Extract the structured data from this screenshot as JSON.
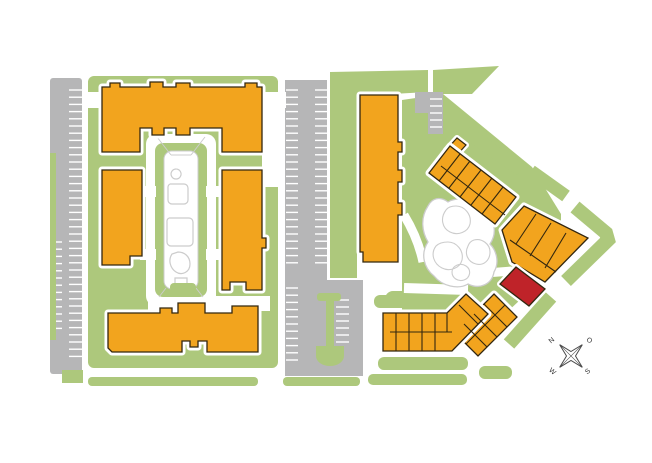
{
  "meta": {
    "viewbox": "0 0 652 463",
    "width": "652",
    "height": "463"
  },
  "colors": {
    "background": "#ffffff",
    "grass": "#adc87c",
    "building": "#f2a41e",
    "highlight": "#bf2329",
    "paving": "#b6b6b7",
    "stall": "#ffffff",
    "outline": "#33270f",
    "path_gray": "#cccccc",
    "halo": "#ffffff",
    "compass": "#4a4a4a",
    "label": "#333333"
  },
  "compass": {
    "labels": {
      "n": "N",
      "e": "O",
      "s": "S",
      "w": "W"
    }
  },
  "layers": [
    {
      "name": "grass-areas",
      "items": [
        {
          "t": "rect",
          "n": "grass-left-block",
          "x": 88,
          "y": 76,
          "w": 190,
          "h": 292,
          "rx": 6,
          "f": "grass"
        },
        {
          "t": "rect",
          "n": "grass-bottom-strip-a",
          "x": 88,
          "y": 377,
          "w": 170,
          "h": 9,
          "rx": 4,
          "f": "grass"
        },
        {
          "t": "rect",
          "n": "grass-bottom-strip-b",
          "x": 283,
          "y": 377,
          "w": 77,
          "h": 9,
          "rx": 4,
          "f": "grass"
        },
        {
          "t": "poly",
          "n": "grass-mid-column",
          "pts": "330,72 428,70 428,92 357,96 357,278 330,278",
          "f": "grass"
        },
        {
          "t": "poly",
          "n": "grass-top-wedge",
          "pts": "433,70 499,66 472,94 433,94",
          "f": "grass"
        },
        {
          "t": "poly",
          "n": "grass-inner-courtyard",
          "pts": "402,100 443,94 532,167 561,214 561,246 520,300 472,345 435,332 402,312",
          "f": "grass"
        },
        {
          "t": "rect",
          "n": "grass-island-a",
          "x": 385,
          "y": 291,
          "w": 46,
          "h": 16,
          "rx": 8,
          "f": "grass"
        },
        {
          "t": "rect",
          "n": "grass-island-b",
          "x": 427,
          "y": 266,
          "w": 33,
          "h": 15,
          "rx": 7,
          "f": "grass"
        },
        {
          "t": "rect",
          "n": "grass-chain-top-strip",
          "x": 374,
          "y": 295,
          "w": 88,
          "h": 13,
          "rx": 6,
          "f": "grass"
        },
        {
          "t": "rect",
          "n": "grass-chain-bottom-strip",
          "x": 378,
          "y": 357,
          "w": 90,
          "h": 13,
          "rx": 6,
          "f": "grass"
        },
        {
          "t": "rect",
          "n": "grass-chain-bottom-strip-2",
          "x": 368,
          "y": 374,
          "w": 99,
          "h": 11,
          "rx": 5,
          "f": "grass"
        },
        {
          "t": "rect",
          "n": "grass-se-connector",
          "x": 479,
          "y": 366,
          "w": 33,
          "h": 13,
          "rx": 6,
          "f": "grass"
        },
        {
          "t": "path",
          "n": "grass-ne-band-a",
          "d": "M466,132 L521,170",
          "f": "none",
          "s": "grass",
          "sw": 13
        },
        {
          "t": "path",
          "n": "grass-ne-band-b",
          "d": "M531,171 L566,196",
          "f": "none",
          "s": "grass",
          "sw": 13
        },
        {
          "t": "path",
          "n": "grass-ne-band-c",
          "d": "M575,207 L606,233 L608,240 L566,281",
          "f": "none",
          "s": "grass",
          "sw": 14
        },
        {
          "t": "path",
          "n": "grass-se-band-d",
          "d": "M551,297 L509,344",
          "f": "none",
          "s": "grass",
          "sw": 14
        }
      ]
    },
    {
      "name": "paving-areas",
      "items": [
        {
          "t": "rect",
          "n": "parking-lot-west",
          "x": 50,
          "y": 78,
          "w": 32,
          "h": 296,
          "rx": 3,
          "f": "paving"
        },
        {
          "t": "poly",
          "n": "parking-lot-central",
          "pts": "285,80 327,80 327,280 363,280 363,376 285,376",
          "f": "paving"
        },
        {
          "t": "poly",
          "n": "parking-patch-north",
          "pts": "415,92 443,92 443,134 428,134 428,113 415,113",
          "f": "paving"
        }
      ]
    },
    {
      "name": "parking-stalls",
      "items": [
        {
          "t": "ticks",
          "n": "stalls-west",
          "x1": 69,
          "x2": 82,
          "y": 90,
          "step": 7.2,
          "count": 38,
          "s": "stall",
          "sw": 1.4
        },
        {
          "t": "ticks",
          "n": "stalls-west-lower",
          "x1": 50,
          "x2": 62,
          "y": 242,
          "step": 7.2,
          "count": 13,
          "s": "stall",
          "sw": 1.4
        },
        {
          "t": "ticks",
          "n": "stalls-central-left",
          "x1": 286,
          "x2": 298,
          "y": 90,
          "step": 7.2,
          "count": 25,
          "s": "stall",
          "sw": 1.4
        },
        {
          "t": "ticks",
          "n": "stalls-central-right",
          "x1": 315,
          "x2": 327,
          "y": 90,
          "step": 7.2,
          "count": 25,
          "s": "stall",
          "sw": 1.4
        },
        {
          "t": "ticks",
          "n": "stalls-central-lower",
          "x1": 286,
          "x2": 298,
          "y": 288,
          "step": 7.2,
          "count": 11,
          "s": "stall",
          "sw": 1.4
        },
        {
          "t": "ticks",
          "n": "stalls-island-stem",
          "x1": 336,
          "x2": 349,
          "y": 300,
          "step": 7,
          "count": 7,
          "s": "stall",
          "sw": 1.4
        },
        {
          "t": "ticks",
          "n": "stalls-north-patch",
          "x1": 430,
          "x2": 442,
          "y": 99,
          "step": 7,
          "count": 5,
          "s": "stall",
          "sw": 1.4
        }
      ]
    },
    {
      "name": "parking-islands",
      "items": [
        {
          "t": "rect",
          "n": "grass-left-edge-sliver",
          "x": 50,
          "y": 153,
          "w": 6,
          "h": 187,
          "f": "grass"
        },
        {
          "t": "rect",
          "n": "grass-bottom-left-square",
          "x": 62,
          "y": 370,
          "w": 21,
          "h": 13,
          "f": "grass"
        },
        {
          "t": "rect",
          "n": "island-cap",
          "x": 317,
          "y": 293,
          "w": 24,
          "h": 8,
          "rx": 3,
          "f": "grass"
        },
        {
          "t": "rect",
          "n": "island-stem",
          "x": 326,
          "y": 301,
          "w": 8,
          "h": 47,
          "f": "grass"
        },
        {
          "t": "path",
          "n": "island-bulb",
          "d": "M316,346 L344,346 L344,356 A14,10 0 0 1 316,356 Z",
          "f": "grass"
        }
      ]
    },
    {
      "name": "roads",
      "items": [
        {
          "t": "rect",
          "n": "road-northwest",
          "x": 82,
          "y": 92,
          "w": 20,
          "h": 16,
          "f": "halo"
        },
        {
          "t": "rect",
          "n": "road-northeast",
          "x": 262,
          "y": 92,
          "w": 24,
          "h": 16,
          "f": "halo"
        },
        {
          "t": "rect",
          "n": "road-east-vertical",
          "x": 262,
          "y": 92,
          "w": 16,
          "h": 95,
          "f": "halo"
        },
        {
          "t": "rect",
          "n": "road-courtyard-south",
          "x": 148,
          "y": 296,
          "w": 122,
          "h": 15,
          "f": "halo"
        },
        {
          "t": "path",
          "n": "walkway-pond-west",
          "d": "M404,215 Q418,238 423,262",
          "f": "none",
          "s": "halo",
          "sw": 9
        },
        {
          "t": "path",
          "n": "walkway-pond-south",
          "d": "M404,288 L468,290",
          "f": "none",
          "s": "halo",
          "sw": 10
        },
        {
          "t": "path",
          "n": "walkway-pond-east",
          "d": "M446,276 L512,271",
          "f": "none",
          "s": "halo",
          "sw": 9
        }
      ]
    },
    {
      "name": "courtyard",
      "items": [
        {
          "t": "rect",
          "n": "courtyard-walk-outer",
          "x": 146,
          "y": 134,
          "w": 70,
          "h": 172,
          "rx": 10,
          "f": "halo"
        },
        {
          "t": "rect",
          "n": "courtyard-green-ring",
          "x": 155,
          "y": 143,
          "w": 52,
          "h": 154,
          "rx": 8,
          "f": "grass"
        },
        {
          "t": "rect",
          "n": "courtyard-walk-inner",
          "x": 164,
          "y": 151,
          "w": 34,
          "h": 138,
          "rx": 8,
          "f": "halo",
          "s": "path_gray",
          "sw": 1
        },
        {
          "t": "rect",
          "n": "courtyard-path-west-1",
          "x": 140,
          "y": 186,
          "w": 16,
          "h": 11,
          "f": "halo"
        },
        {
          "t": "rect",
          "n": "courtyard-path-east-1",
          "x": 206,
          "y": 186,
          "w": 16,
          "h": 11,
          "f": "halo"
        },
        {
          "t": "rect",
          "n": "courtyard-path-west-2",
          "x": 140,
          "y": 249,
          "w": 16,
          "h": 11,
          "f": "halo"
        },
        {
          "t": "rect",
          "n": "courtyard-path-east-2",
          "x": 206,
          "y": 249,
          "w": 16,
          "h": 11,
          "f": "halo"
        },
        {
          "t": "path",
          "n": "courtyard-trellis-lines",
          "d": "M157,137 L171,155 M205,137 L191,155 M171,155 L191,155 M166,288 L159,297 M196,288 L203,297",
          "f": "none",
          "s": "path_gray",
          "sw": 1
        },
        {
          "t": "path",
          "n": "courtyard-pool-shapes",
          "d": "M176,169 a5,5 0 1 0 0.1,0 M170,184 h14 a4,4 0 0 1 4,4 v12 a4,4 0 0 1 -4,4 h-12 a4,4 0 0 1 -4,-4 v-12 a4,4 0 0 1 2,-4 M169,218 h20 a4,4 0 0 1 4,4 v20 a4,4 0 0 1 -4,4 h-18 a4,4 0 0 1 -4,-4 v-20 a4,4 0 0 1 2,-4 M172,254 c-4,6 -2,14 4,18 c6,4 14,0 14,-8 c0,-8 -6,-12 -12,-12 z M175,278 h12 v8 h-12 z",
          "f": "none",
          "s": "path_gray",
          "sw": 1.2
        },
        {
          "t": "rect",
          "n": "courtyard-deck",
          "x": 170,
          "y": 283,
          "w": 26,
          "h": 9,
          "rx": 4,
          "f": "grass"
        }
      ]
    },
    {
      "name": "pond",
      "items": [
        {
          "t": "path",
          "n": "pond-outline",
          "d": "M428,206 C420,218 422,232 428,242 C420,254 424,268 434,276 C442,286 458,290 468,284 C480,290 492,284 494,272 C500,262 496,250 490,244 C498,232 494,218 484,212 C476,200 458,196 448,202 C440,196 432,198 428,206 Z",
          "f": "halo",
          "s": "path_gray",
          "sw": 1.3
        },
        {
          "t": "path",
          "n": "pond-planting-cells",
          "d": "M446,210 c-6,8 -4,18 4,22 c8,4 18,0 20,-8 c2,-10 -6,-18 -14,-18 c-4,0 -8,1 -10,4 z M436,246 c-6,8 -2,18 6,22 c8,4 18,0 20,-8 c2,-10 -6,-18 -14,-18 c-5,0 -9,1 -12,4 z M468,246 c-4,8 0,16 8,18 c8,2 14,-4 14,-12 c0,-8 -8,-14 -16,-12 c-3,1 -5,3 -6,6 z M452,272 c0,6 6,10 12,8 c6,-2 8,-10 2,-14 c-6,-4 -14,0 -14,6 z",
          "f": "halo",
          "s": "path_gray",
          "sw": 1.1
        }
      ]
    },
    {
      "name": "buildings",
      "items": [
        {
          "t": "path",
          "n": "building-west-north",
          "i": true,
          "halo": 7,
          "f": "building",
          "s": "outline",
          "sw": 1.3,
          "d": "M102,87 L110,87 L110,83 L120,83 L120,87 L150,87 L150,82 L163,82 L163,87 L176,87 L176,83 L190,83 L190,87 L245,87 L245,83 L257,83 L257,87 L262,87 L262,152 L222,152 L222,128 L190,128 L190,135 L176,135 L176,128 L164,128 L164,135 L152,135 L152,128 L140,128 L140,152 L102,152 Z"
        },
        {
          "t": "path",
          "n": "building-west-left",
          "i": true,
          "halo": 7,
          "f": "building",
          "s": "outline",
          "sw": 1.3,
          "d": "M102,170 L142,170 L142,256 L130,256 L130,265 L102,265 Z"
        },
        {
          "t": "path",
          "n": "building-west-right",
          "i": true,
          "halo": 7,
          "f": "building",
          "s": "outline",
          "sw": 1.3,
          "d": "M222,170 L262,170 L262,238 L266,238 L266,248 L262,248 L262,290 L246,290 L246,282 L230,282 L230,290 L222,290 Z"
        },
        {
          "t": "path",
          "n": "building-west-south",
          "i": true,
          "halo": 7,
          "f": "building",
          "s": "outline",
          "sw": 1.3,
          "d": "M108,313 L160,313 L160,308 L172,308 L172,313 L178,313 L178,303 L205,303 L205,313 L232,313 L232,306 L258,306 L258,352 L207,352 L207,341 L198,341 L198,347 L190,347 L190,341 L182,341 L182,352 L112,352 L108,348 Z"
        },
        {
          "t": "path",
          "n": "building-central-tower",
          "i": true,
          "halo": 7,
          "f": "building",
          "s": "outline",
          "sw": 1.3,
          "d": "M360,95 L398,95 L398,142 L402,142 L402,152 L398,152 L398,170 L402,170 L402,182 L398,182 L398,203 L402,203 L402,215 L398,215 L398,262 L363,262 L363,252 L360,252 Z"
        },
        {
          "t": "poly",
          "n": "building-arm-ne-tip",
          "i": true,
          "halo": 6,
          "f": "building",
          "s": "outline",
          "sw": 1.2,
          "pts": "446,150 457,138 466,145 455,157"
        },
        {
          "t": "poly",
          "n": "building-arm-ne",
          "i": true,
          "halo": 7,
          "f": "building",
          "s": "outline",
          "sw": 1.3,
          "pts": "450,146 516,197 495,224 429,173"
        },
        {
          "t": "poly",
          "n": "building-bend",
          "i": true,
          "halo": 7,
          "f": "building",
          "s": "outline",
          "sw": 1.3,
          "pts": "524,206 588,238 545,282 512,262 502,230"
        },
        {
          "t": "poly",
          "n": "building-arm-se",
          "i": true,
          "halo": 7,
          "f": "building",
          "s": "outline",
          "sw": 1.3,
          "pts": "494,294 517,317 478,356 455,333"
        },
        {
          "t": "path",
          "n": "building-chain-south",
          "i": true,
          "halo": 7,
          "f": "building",
          "s": "outline",
          "sw": 1.3,
          "d": "M383,313 L447,313 L466,294 L488,314 L452,351 L383,351 Z"
        },
        {
          "t": "poly",
          "n": "building-unit-highlight",
          "i": true,
          "halo": 6,
          "f": "highlight",
          "s": "outline",
          "sw": 1.3,
          "pts": "516,267 545,289 529,306 500,284"
        }
      ]
    },
    {
      "name": "unit-lines",
      "items": [
        {
          "t": "path",
          "n": "unit-lines-arm-ne",
          "f": "none",
          "s": "outline",
          "sw": 1.1,
          "d": "M460,154 L439,181 M470,161 L449,188 M481,170 L460,197 M492,178 L471,205 M503,187 L482,214 M441,166 L505,215"
        },
        {
          "t": "path",
          "n": "unit-lines-bend",
          "f": "none",
          "s": "outline",
          "sw": 1.1,
          "d": "M536,214 L516,244 M551,223 L530,256 M566,233 L545,268 M510,240 L556,272"
        },
        {
          "t": "path",
          "n": "unit-lines-arm-se",
          "f": "none",
          "s": "outline",
          "sw": 1.1,
          "d": "M484,304 L507,327 M474,314 L497,337 M464,324 L487,347 M505,305 L466,344"
        },
        {
          "t": "path",
          "n": "unit-lines-chain-south",
          "f": "none",
          "s": "outline",
          "sw": 1.1,
          "d": "M396,313 L396,351 M409,313 L409,351 M422,313 L422,351 M435,313 L435,351 M390,332 L452,332 M447,313 L447,332 M459,305 L478,324"
        }
      ]
    },
    {
      "name": "compass",
      "items": [
        {
          "t": "path",
          "n": "compass-rose",
          "f": "halo",
          "s": "compass",
          "sw": 1,
          "d": "M571,351.5 L582.3,344.7 L575.5,356 L582.3,367.3 L571,360.5 L559.7,367.3 L566.5,356 L559.7,344.7 Z"
        },
        {
          "t": "path",
          "n": "compass-cross",
          "f": "none",
          "s": "compass",
          "sw": 0.6,
          "d": "M582.3,344.7 L559.7,367.3 M559.7,344.7 L582.3,367.3"
        },
        {
          "t": "text",
          "n": "compass-label-north",
          "x": 553,
          "y": 342,
          "rot": -40,
          "key": "n",
          "bind": "compass.labels.n"
        },
        {
          "t": "text",
          "n": "compass-label-east",
          "x": 588,
          "y": 342,
          "rot": 40,
          "key": "e",
          "bind": "compass.labels.e"
        },
        {
          "t": "text",
          "n": "compass-label-south",
          "x": 589,
          "y": 373,
          "rot": -40,
          "key": "s",
          "bind": "compass.labels.s"
        },
        {
          "t": "text",
          "n": "compass-label-west",
          "x": 551,
          "y": 373,
          "rot": 40,
          "key": "w",
          "bind": "compass.labels.w"
        }
      ]
    }
  ]
}
